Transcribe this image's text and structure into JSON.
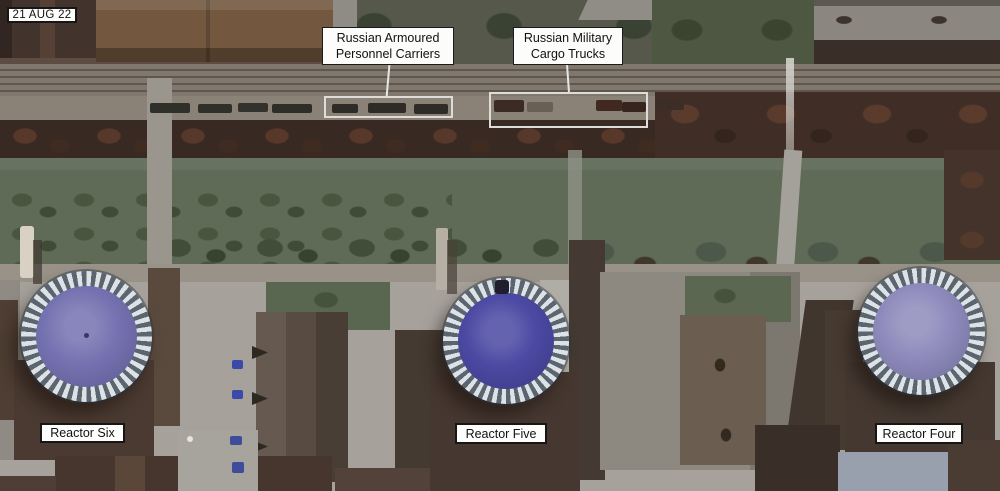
{
  "date_label": "21 AUG 22",
  "callouts": {
    "apc": {
      "line1": "Russian Armoured",
      "line2": "Personnel Carriers"
    },
    "trucks": {
      "line1": "Russian Military",
      "line2": "Cargo Trucks"
    }
  },
  "reactors": {
    "six": {
      "label": "Reactor Six",
      "dome_color": "#7572b1"
    },
    "five": {
      "label": "Reactor Five",
      "dome_color": "#4b49a2"
    },
    "four": {
      "label": "Reactor Four",
      "dome_color": "#8e8bbc"
    }
  },
  "annotation_style": {
    "box_background": "#fdfdfc",
    "box_border": "#161616",
    "highlight_color": "#dddcd8"
  }
}
